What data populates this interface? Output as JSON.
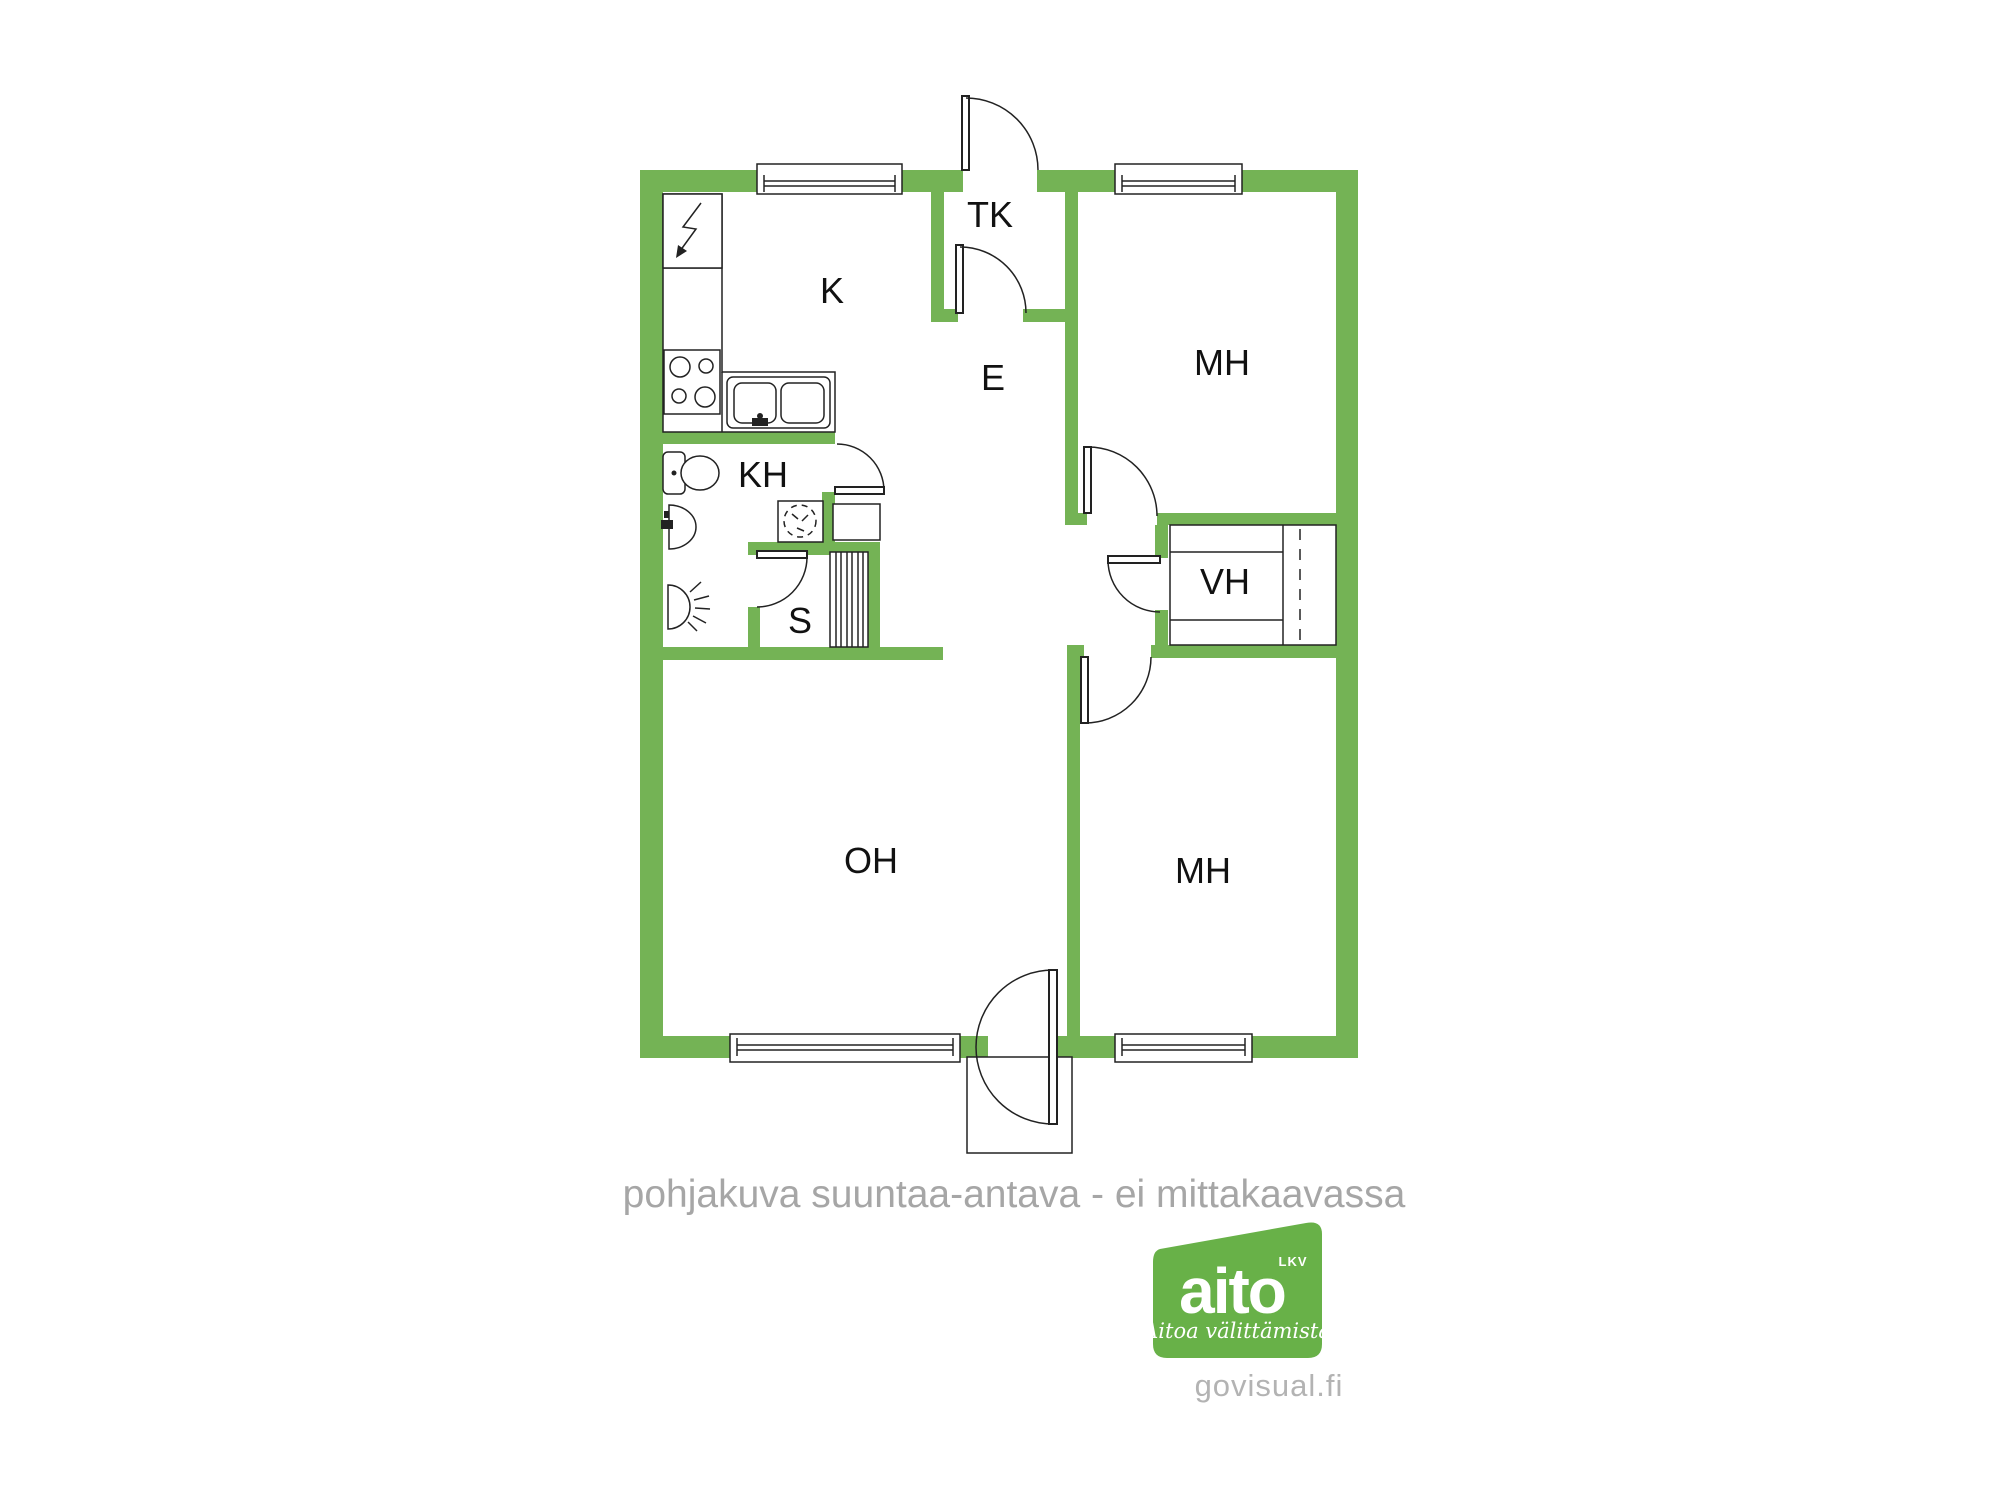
{
  "colors": {
    "wall_green": "#74b355",
    "logo_green": "#68b148",
    "line_dark": "#222222",
    "caption_gray": "#a6a6a6",
    "footer_gray": "#b3b3b3",
    "label_dark": "#111111"
  },
  "floorplan": {
    "labels": {
      "k": "K",
      "tk": "TK",
      "e": "E",
      "mh_top": "MH",
      "vh": "VH",
      "kh": "KH",
      "s": "S",
      "oh": "OH",
      "mh_bottom": "MH"
    },
    "fixture_icons": [
      "electrical-panel-icon",
      "stove-icon",
      "kitchen-sink-icon",
      "toilet-icon",
      "washbasin-icon",
      "shower-icon",
      "washing-machine-icon",
      "hall-closet-icon",
      "sauna-benches-icon",
      "wardrobe-icon",
      "entry-porch"
    ]
  },
  "caption": "pohjakuva suuntaa-antava - ei mittakaavassa",
  "logo": {
    "brand": "aito",
    "suffix": "LKV",
    "tagline": "Aitoa välittämistä",
    "website": "govisual.fi"
  }
}
